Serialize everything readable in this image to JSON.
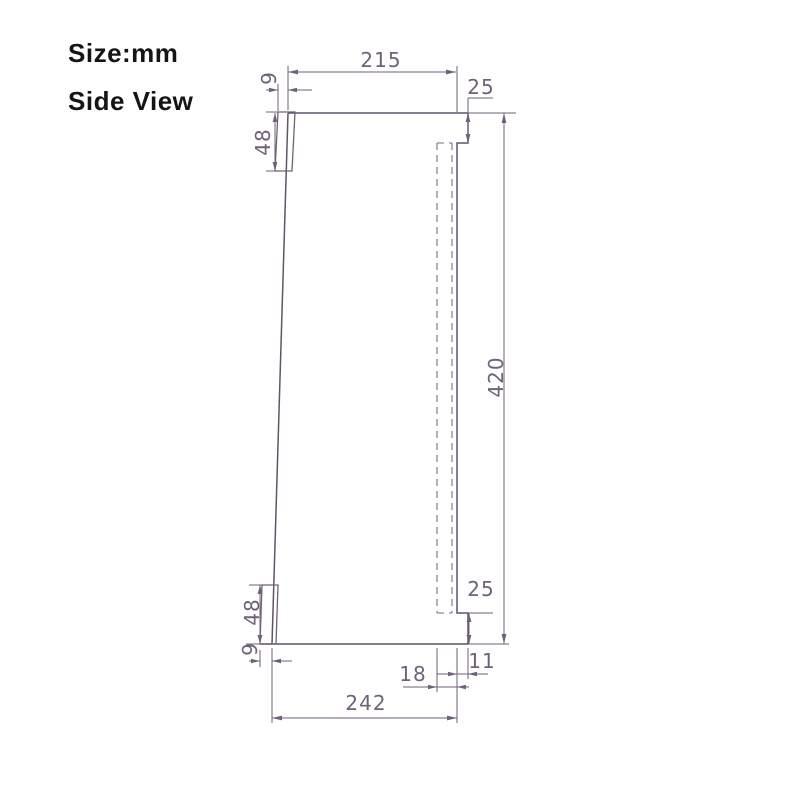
{
  "title": {
    "size_label": "Size:mm",
    "view_label": "Side View"
  },
  "drawing": {
    "unit": "mm",
    "dims": {
      "top_width": "215",
      "top_offset": "9",
      "top_bracket_height": "48",
      "top_right_inset": "25",
      "overall_height": "420",
      "bottom_right_inset": "25",
      "bottom_bracket_height": "48",
      "bottom_offset": "9",
      "bottom_slot_width": "18",
      "bottom_edge_width": "11",
      "bottom_width": "242"
    },
    "colors": {
      "line": "#6f6278",
      "outline": "#5f5468",
      "title_text": "#151515",
      "background": "#ffffff"
    }
  }
}
